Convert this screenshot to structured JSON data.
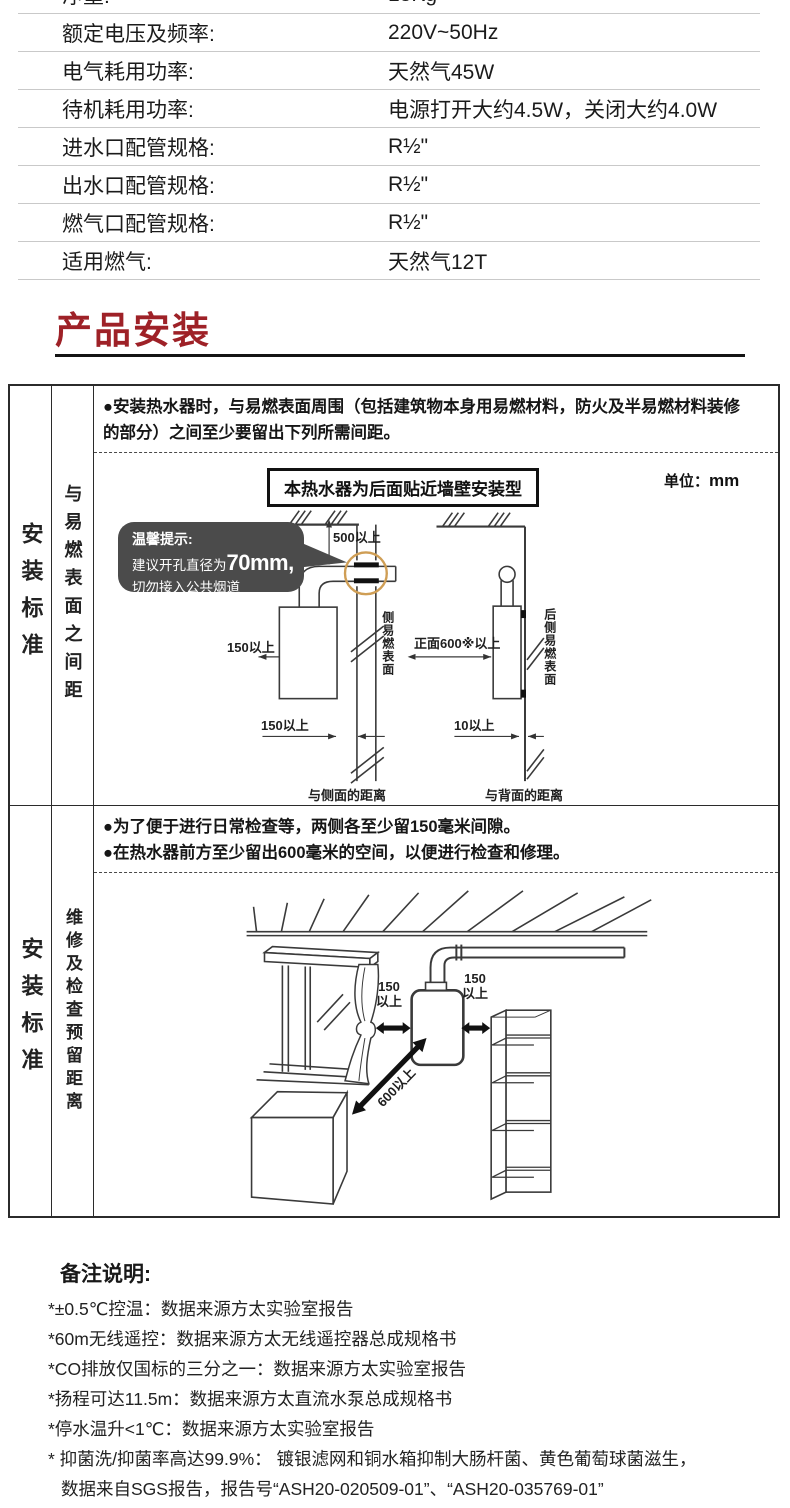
{
  "spec_table": {
    "rows": [
      {
        "label": "净重:",
        "value": "13Kg"
      },
      {
        "label": "额定电压及频率:",
        "value": "220V~50Hz"
      },
      {
        "label": "电气耗用功率:",
        "value": "天然气45W"
      },
      {
        "label": "待机耗用功率:",
        "value": "电源打开大约4.5W，关闭大约4.0W"
      },
      {
        "label": "进水口配管规格:",
        "value": "R½\""
      },
      {
        "label": "出水口配管规格:",
        "value": "R½\""
      },
      {
        "label": "燃气口配管规格:",
        "value": "R½\""
      },
      {
        "label": "适用燃气:",
        "value": "天然气12T"
      }
    ]
  },
  "heading": {
    "title": "产品安装",
    "accent_color": "#9e2127"
  },
  "install": {
    "row1": {
      "side_label": "安装标准",
      "category_label": "与易燃表面之间距",
      "bullet1": "●安装热水器时，与易燃表面周围（包括建筑物本身用易燃材料，防火及半易燃材料装修",
      "bullet2": "的部分）之间至少要留出下列所需间距。",
      "diagram": {
        "title": "本热水器为后面贴近墙壁安装型",
        "unit_label": "单位：",
        "unit_value": "mm",
        "tip_line1": "温馨提示:",
        "tip_line2_pre": "建议开孔直径为",
        "tip_line2_big": "70mm,",
        "tip_line3": "切勿接入公共烟道",
        "dim_500": "500以上",
        "dim_150_side": "150以上",
        "dim_150_bottom": "150以上",
        "side_surface": "侧易燃表面",
        "caption_side": "与侧面的距离",
        "dim_front": "正面600※以上",
        "rear_surface": "后侧易燃表面",
        "dim_10": "10以上",
        "caption_rear": "与背面的距离",
        "circle_color": "#cf9e55"
      }
    },
    "row2": {
      "side_label": "安装标准",
      "category_label": "维修及检查预留距离",
      "bullet1": "●为了便于进行日常检查等，两侧各至少留150毫米间隙。",
      "bullet2": "●在热水器前方至少留出600毫米的空间，以便进行检查和修理。",
      "diagram": {
        "dim_150_left_a": "150",
        "dim_150_left_b": "以上",
        "dim_150_right_a": "150",
        "dim_150_right_b": "以上",
        "dim_600": "600以上"
      }
    }
  },
  "notes": {
    "heading": "备注说明:",
    "items": [
      "*±0.5℃控温：数据来源方太实验室报告",
      "*60m无线遥控：数据来源方太无线遥控器总成规格书",
      "*CO排放仅国标的三分之一：数据来源方太实验室报告",
      "*扬程可达11.5m：数据来源方太直流水泵总成规格书",
      "*停水温升<1℃：数据来源方太实验室报告",
      "* 抑菌洗/抑菌率高达99.9%： 镀银滤网和铜水箱抑制大肠杆菌、黄色葡萄球菌滋生，",
      "数据来自SGS报告，报告号“ASH20-020509-01”、“ASH20-035769-01”"
    ]
  }
}
